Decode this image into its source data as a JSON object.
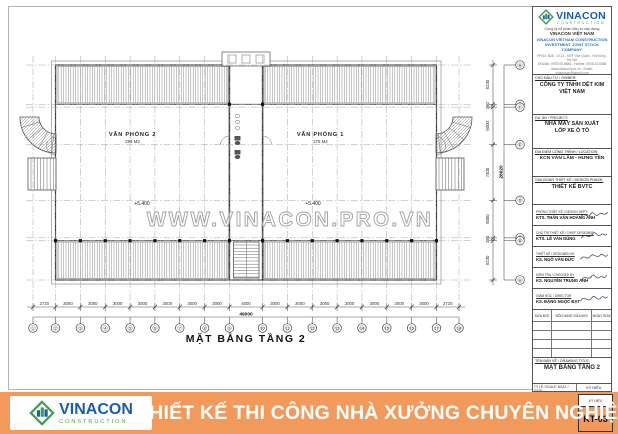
{
  "logo": {
    "name": "VINACON",
    "tagline": "CONSTRUCTION"
  },
  "company": {
    "line1": "Công ty cổ phần đầu tư xây dựng",
    "line2": "VINACON VIỆT NAM",
    "en1": "VINACON VIETNAM CONSTRUCTION",
    "en2": "INVESTMENT JOINT STOCK COMPANY",
    "addr": "VPGD: B28 - LK13 - KĐT Văn Quán - Hà Đông - Hà Nội",
    "tel": "Tel/Zalo: 0975.05.6886 - Hotline: 0936.23.6886",
    "web": "www.vinacon.pro.vn - Email: vinaconvn@gmail.com"
  },
  "titleblock": {
    "owner_label": "CHỦ ĐẦU TƯ / OWNER:",
    "owner_line1": "CÔNG TY TNHH DỆT KIM",
    "owner_line2": "VIỆT NAM",
    "project_label": "DỰ ÁN / PROJECT:",
    "project_line1": "NHÀ MÁY SẢN XUẤT",
    "project_line2": "LỐP XE Ô TÔ",
    "location_label": "ĐỊA ĐIỂM CÔNG TRÌNH / LOCATION:",
    "location": "KCN VĂN LÂM - HƯNG YÊN",
    "phase_label": "GIAI ĐOẠN THIẾT KẾ / DESIGN PHASE:",
    "phase": "THIẾT KẾ BVTC",
    "signatures": [
      {
        "role": "PHÒNG THIẾT KẾ / DESIGN DEPT.",
        "name": "KTS. THÂN VĂN HOÀNG ANH"
      },
      {
        "role": "CHỦ TRÌ THIẾT KẾ / CHIEF DESIGNER",
        "name": "KTS. LÊ VĂN DŨNG"
      },
      {
        "role": "THIẾT KẾ / DESIGNED BY",
        "name": "KS. NGÔ VĂN ĐỨC"
      },
      {
        "role": "KIỂM TRA / CHECKED BY",
        "name": "KS. NGUYỄN TRUNG ANH"
      },
      {
        "role": "GIÁM ĐỐC / DIRECTOR",
        "name": "KS. ĐẶNG NGỌC ĐẠT"
      }
    ],
    "revision_headers": [
      "SỬA ĐỔI",
      "NỘI DUNG SỬA ĐỔI",
      "NGÀY SỬA"
    ],
    "drawing_title_label": "TÊN BẢN VẼ / DRAWING TITLE:",
    "drawing_title": "MẶT BẰNG TẦNG 2",
    "scale_label": "TỶ LỆ / SCALE:",
    "date_label": "NGÀY / DATE:",
    "sheet_label": "KÝ HIỆU",
    "sheet_no": "KT-03"
  },
  "banner": {
    "slogan": "THIẾT KẾ THI CÔNG NHÀ XƯỞNG CHUYÊN NGHIỆP"
  },
  "plan": {
    "title": "MẶT BẰNG TẦNG 2",
    "watermark": "WWW.VINACON.PRO.VN",
    "rooms": [
      {
        "name": "VĂN PHÒNG 2",
        "area": "259 M2",
        "level": "+5.400"
      },
      {
        "name": "VĂN PHÒNG 1",
        "area": "275 M2",
        "level": "+5.400"
      }
    ],
    "dims_bottom": [
      "2720",
      "3000",
      "3000",
      "3000",
      "3000",
      "3000",
      "3000",
      "3000",
      "4000",
      "3000",
      "3000",
      "3000",
      "3000",
      "3000",
      "3000",
      "3000",
      "2720"
    ],
    "dim_total_bottom": "49000",
    "grid_cols": [
      "1",
      "2",
      "3",
      "4",
      "5",
      "6",
      "7",
      "8",
      "9",
      "10",
      "11",
      "12",
      "13",
      "14",
      "15",
      "16",
      "17",
      "18"
    ],
    "dims_right": [
      "5230",
      "380",
      "5000",
      "7400",
      "5000",
      "380",
      "5230"
    ],
    "dim_total_right": "28620",
    "grid_rows": [
      "H",
      "G",
      "F",
      "E",
      "D",
      "C",
      "B",
      "A"
    ]
  }
}
